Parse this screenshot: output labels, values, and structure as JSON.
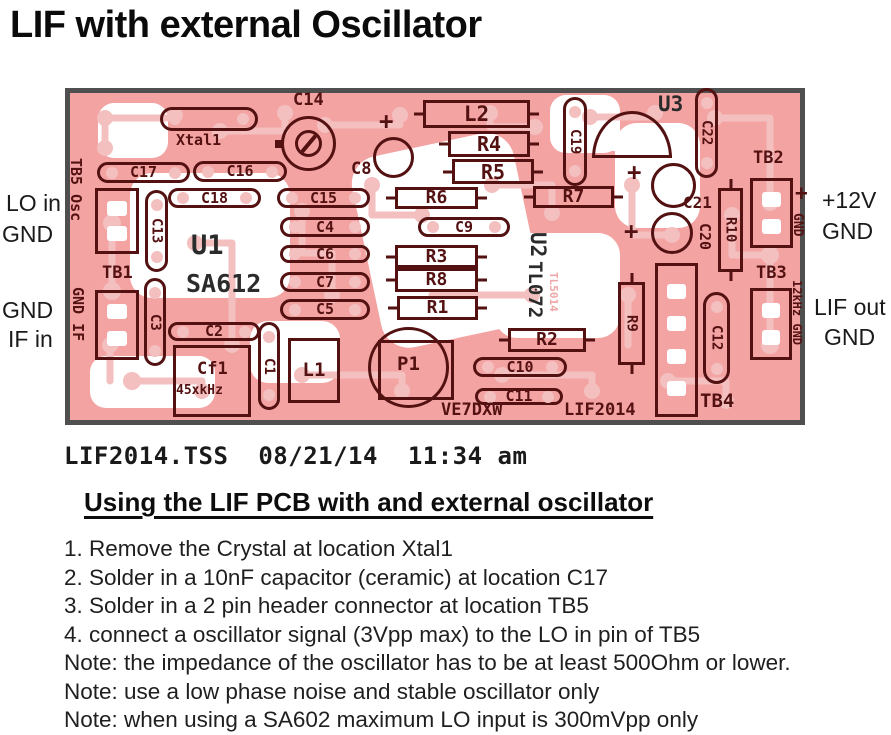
{
  "title": "LIF with external Oscillator",
  "plot_caption": "LIF2014.TSS  08/21/14  11:34 am",
  "colors": {
    "board_pink": "#f4a3a3",
    "trace_pink": "#f3bfbf",
    "silkscreen_maroon": "#541111",
    "board_border_gray": "#4f4f4f"
  },
  "side_labels": {
    "left": [
      {
        "text": "LO in",
        "x": 6,
        "y": 192
      },
      {
        "text": "GND",
        "x": 2,
        "y": 223
      },
      {
        "text": "GND",
        "x": 2,
        "y": 299
      },
      {
        "text": "IF in",
        "x": 8,
        "y": 328
      }
    ],
    "right": [
      {
        "text": "+12V",
        "x": 822,
        "y": 189
      },
      {
        "text": "GND",
        "x": 822,
        "y": 220
      },
      {
        "text": "LIF out",
        "x": 814,
        "y": 296
      },
      {
        "text": "GND",
        "x": 824,
        "y": 326
      }
    ]
  },
  "board": {
    "shapes": [
      {
        "id": "xtal1-outline",
        "type": "hpill",
        "x": 160,
        "y": 107,
        "w": 98,
        "h": 24
      },
      {
        "id": "c14-trimmer",
        "type": "trimmer",
        "x": 281,
        "y": 116,
        "w": 55,
        "h": 55
      },
      {
        "id": "c8-body",
        "type": "circle",
        "x": 373,
        "y": 137,
        "w": 41,
        "h": 41
      },
      {
        "id": "c17",
        "type": "hpill",
        "x": 97,
        "y": 162,
        "w": 93,
        "h": 21,
        "label": "C17"
      },
      {
        "id": "c16",
        "type": "hpill",
        "x": 193,
        "y": 161,
        "w": 94,
        "h": 21,
        "label": "C16"
      },
      {
        "id": "c18",
        "type": "hpill",
        "x": 168,
        "y": 188,
        "w": 93,
        "h": 20,
        "label": "C18"
      },
      {
        "id": "c15",
        "type": "hpill",
        "x": 277,
        "y": 188,
        "w": 93,
        "h": 20,
        "label": "C15"
      },
      {
        "id": "c4",
        "type": "hpill",
        "x": 280,
        "y": 217,
        "w": 90,
        "h": 20,
        "label": "C4"
      },
      {
        "id": "c6",
        "type": "hpill",
        "x": 280,
        "y": 245,
        "w": 90,
        "h": 18,
        "label": "C6"
      },
      {
        "id": "c7",
        "type": "hpill",
        "x": 280,
        "y": 272,
        "w": 90,
        "h": 20,
        "label": "C7"
      },
      {
        "id": "c5",
        "type": "hpill",
        "x": 280,
        "y": 299,
        "w": 90,
        "h": 21,
        "label": "C5"
      },
      {
        "id": "c13",
        "type": "vpill",
        "x": 145,
        "y": 190,
        "w": 23,
        "h": 82,
        "label": "C13"
      },
      {
        "id": "c3",
        "type": "vpill",
        "x": 144,
        "y": 278,
        "w": 22,
        "h": 88,
        "label": "C3"
      },
      {
        "id": "c2",
        "type": "hpill",
        "x": 168,
        "y": 322,
        "w": 92,
        "h": 19,
        "label": "C2"
      },
      {
        "id": "c1",
        "type": "vpill",
        "x": 258,
        "y": 322,
        "w": 22,
        "h": 88,
        "label": "C1"
      },
      {
        "id": "cf1-outline",
        "type": "rect",
        "x": 173,
        "y": 345,
        "w": 78,
        "h": 72
      },
      {
        "id": "l1",
        "type": "rect",
        "x": 288,
        "y": 338,
        "w": 52,
        "h": 65,
        "label": "L1",
        "fs": 19
      },
      {
        "id": "tb5-connector",
        "type": "rect",
        "x": 95,
        "y": 188,
        "w": 44,
        "h": 66,
        "pads": 2
      },
      {
        "id": "tb1-connector",
        "type": "rect",
        "x": 95,
        "y": 290,
        "w": 44,
        "h": 70,
        "pads": 2
      },
      {
        "id": "l2",
        "type": "hbox",
        "x": 423,
        "y": 100,
        "w": 107,
        "h": 28,
        "label": "L2",
        "fs": 21
      },
      {
        "id": "r4",
        "type": "hbox",
        "x": 448,
        "y": 131,
        "w": 82,
        "h": 26,
        "label": "R4",
        "fs": 20
      },
      {
        "id": "r5",
        "type": "hbox",
        "x": 452,
        "y": 159,
        "w": 82,
        "h": 25,
        "label": "R5",
        "fs": 20
      },
      {
        "id": "r6",
        "type": "hbox",
        "x": 395,
        "y": 187,
        "w": 83,
        "h": 22,
        "label": "R6",
        "fs": 18
      },
      {
        "id": "r7",
        "type": "hbox",
        "x": 533,
        "y": 186,
        "w": 81,
        "h": 22,
        "label": "R7",
        "fs": 18
      },
      {
        "id": "c9",
        "type": "hpill",
        "x": 418,
        "y": 217,
        "w": 92,
        "h": 20,
        "label": "C9"
      },
      {
        "id": "r3",
        "type": "hbox",
        "x": 395,
        "y": 245,
        "w": 83,
        "h": 23,
        "label": "R3",
        "fs": 18
      },
      {
        "id": "r8",
        "type": "hbox",
        "x": 395,
        "y": 268,
        "w": 83,
        "h": 24,
        "label": "R8",
        "fs": 18
      },
      {
        "id": "r1",
        "type": "hbox",
        "x": 397,
        "y": 296,
        "w": 81,
        "h": 24,
        "label": "R1",
        "fs": 18
      },
      {
        "id": "p1-square",
        "type": "box",
        "x": 378,
        "y": 340,
        "w": 76,
        "h": 60
      },
      {
        "id": "p1-body",
        "type": "circle",
        "x": 368,
        "y": 327,
        "w": 81,
        "h": 81
      },
      {
        "id": "r2",
        "type": "hbox",
        "x": 508,
        "y": 328,
        "w": 78,
        "h": 24,
        "label": "R2",
        "fs": 18
      },
      {
        "id": "c10",
        "type": "hpill",
        "x": 473,
        "y": 357,
        "w": 94,
        "h": 20,
        "label": "C10"
      },
      {
        "id": "c11",
        "type": "hpill",
        "x": 475,
        "y": 388,
        "w": 88,
        "h": 17,
        "label": "C11"
      },
      {
        "id": "c19",
        "type": "vpill",
        "x": 563,
        "y": 97,
        "w": 24,
        "h": 89,
        "label": "C19"
      },
      {
        "id": "u3-outline",
        "type": "dome",
        "x": 592,
        "y": 111,
        "w": 80,
        "h": 47
      },
      {
        "id": "c22",
        "type": "vpill",
        "x": 695,
        "y": 88,
        "w": 23,
        "h": 90,
        "label": "C22"
      },
      {
        "id": "c21-body",
        "type": "circle",
        "x": 651,
        "y": 163,
        "w": 45,
        "h": 45
      },
      {
        "id": "c20-body",
        "type": "circle",
        "x": 651,
        "y": 212,
        "w": 42,
        "h": 42
      },
      {
        "id": "r10",
        "type": "vbox",
        "x": 718,
        "y": 188,
        "w": 25,
        "h": 84,
        "label": "R10"
      },
      {
        "id": "tb2-connector",
        "type": "rect",
        "x": 750,
        "y": 178,
        "w": 43,
        "h": 70,
        "pads": 2
      },
      {
        "id": "r9",
        "type": "vbox",
        "x": 618,
        "y": 282,
        "w": 27,
        "h": 83,
        "label": "R9"
      },
      {
        "id": "tb4-connector",
        "type": "rect",
        "x": 655,
        "y": 263,
        "w": 43,
        "h": 154,
        "pads": 4
      },
      {
        "id": "c12",
        "type": "vpill",
        "x": 703,
        "y": 292,
        "w": 27,
        "h": 92,
        "label": "C12"
      },
      {
        "id": "tb3-connector",
        "type": "rect",
        "x": 750,
        "y": 288,
        "w": 42,
        "h": 72,
        "pads": 2
      }
    ],
    "labels": [
      {
        "id": "xtal1-label",
        "text": "Xtal1",
        "x": 176,
        "y": 133,
        "fs": 15
      },
      {
        "id": "c14-label",
        "text": "C14",
        "x": 293,
        "y": 92,
        "fs": 17
      },
      {
        "id": "c8-label",
        "text": "C8",
        "x": 351,
        "y": 161,
        "fs": 17
      },
      {
        "id": "c8-plus",
        "text": "+",
        "x": 379,
        "y": 109,
        "fs": 24
      },
      {
        "id": "u3-label",
        "text": "U3",
        "x": 658,
        "y": 94,
        "fs": 21,
        "dark": true
      },
      {
        "id": "c21-plus",
        "text": "+",
        "x": 627,
        "y": 160,
        "fs": 24
      },
      {
        "id": "c20-plus",
        "text": "+",
        "x": 624,
        "y": 219,
        "fs": 24
      },
      {
        "id": "c21-label",
        "text": "C21",
        "x": 683,
        "y": 195,
        "fs": 16
      },
      {
        "id": "c20-label",
        "text": "C20",
        "x": 697,
        "y": 223,
        "fs": 15,
        "rot": true
      },
      {
        "id": "tb2-label",
        "text": "TB2",
        "x": 753,
        "y": 150,
        "fs": 17
      },
      {
        "id": "tb2-plus",
        "text": "+",
        "x": 795,
        "y": 183,
        "fs": 21
      },
      {
        "id": "tb2-gnd",
        "text": "GND",
        "x": 791,
        "y": 213,
        "fs": 13,
        "rot": true
      },
      {
        "id": "tb3-label",
        "text": "TB3",
        "x": 756,
        "y": 265,
        "fs": 17
      },
      {
        "id": "tb3-12khz",
        "text": "12kHz GND",
        "x": 791,
        "y": 280,
        "fs": 12,
        "rot": true
      },
      {
        "id": "tb4-label",
        "text": "TB4",
        "x": 700,
        "y": 392,
        "fs": 19
      },
      {
        "id": "tb1-label",
        "text": "TB1",
        "x": 102,
        "y": 265,
        "fs": 17
      },
      {
        "id": "tb1-gndif",
        "text": "GND IF",
        "x": 70,
        "y": 287,
        "fs": 15,
        "rot": true
      },
      {
        "id": "tb5-osc",
        "text": "TB5 Osc",
        "x": 68,
        "y": 158,
        "fs": 15,
        "rot": true
      },
      {
        "id": "u1-label",
        "text": "U1",
        "x": 191,
        "y": 232,
        "fs": 27,
        "dark": true
      },
      {
        "id": "sa612-label",
        "text": "SA612",
        "x": 186,
        "y": 271,
        "fs": 25,
        "dark": true
      },
      {
        "id": "u2-label",
        "text": "U2",
        "x": 527,
        "y": 232,
        "fs": 21,
        "rot": true,
        "dark": true
      },
      {
        "id": "tl072-label",
        "text": "TL072",
        "x": 525,
        "y": 261,
        "fs": 19,
        "rot": true,
        "dark": true
      },
      {
        "id": "tl5014-label",
        "text": "TL5014",
        "x": 548,
        "y": 272,
        "fs": 11,
        "rot": true,
        "copper": true
      },
      {
        "id": "p1-label",
        "text": "P1",
        "x": 397,
        "y": 355,
        "fs": 19
      },
      {
        "id": "cf1-label",
        "text": "Cf1",
        "x": 197,
        "y": 361,
        "fs": 17
      },
      {
        "id": "cf1-freq",
        "text": "45xkHz",
        "x": 176,
        "y": 384,
        "fs": 13
      },
      {
        "id": "ve7dxw-label",
        "text": "VE7DXW",
        "x": 441,
        "y": 402,
        "fs": 17
      },
      {
        "id": "lif2014-label",
        "text": "LIF2014",
        "x": 564,
        "y": 402,
        "fs": 17
      }
    ]
  },
  "instructions": {
    "heading": "Using the LIF PCB with and external oscillator",
    "items": [
      "1. Remove the Crystal at location Xtal1",
      "2. Solder in a 10nF capacitor (ceramic) at location C17",
      "3. Solder in a 2 pin header connector at location TB5",
      "4. connect a oscillator signal (3Vpp max) to the LO in pin of TB5",
      "Note: the impedance of the oscillator has to be at least 500Ohm or lower.",
      "Note: use a low phase noise and stable oscillator only",
      "Note: when using a SA602 maximum LO input is 300mVpp only"
    ]
  }
}
